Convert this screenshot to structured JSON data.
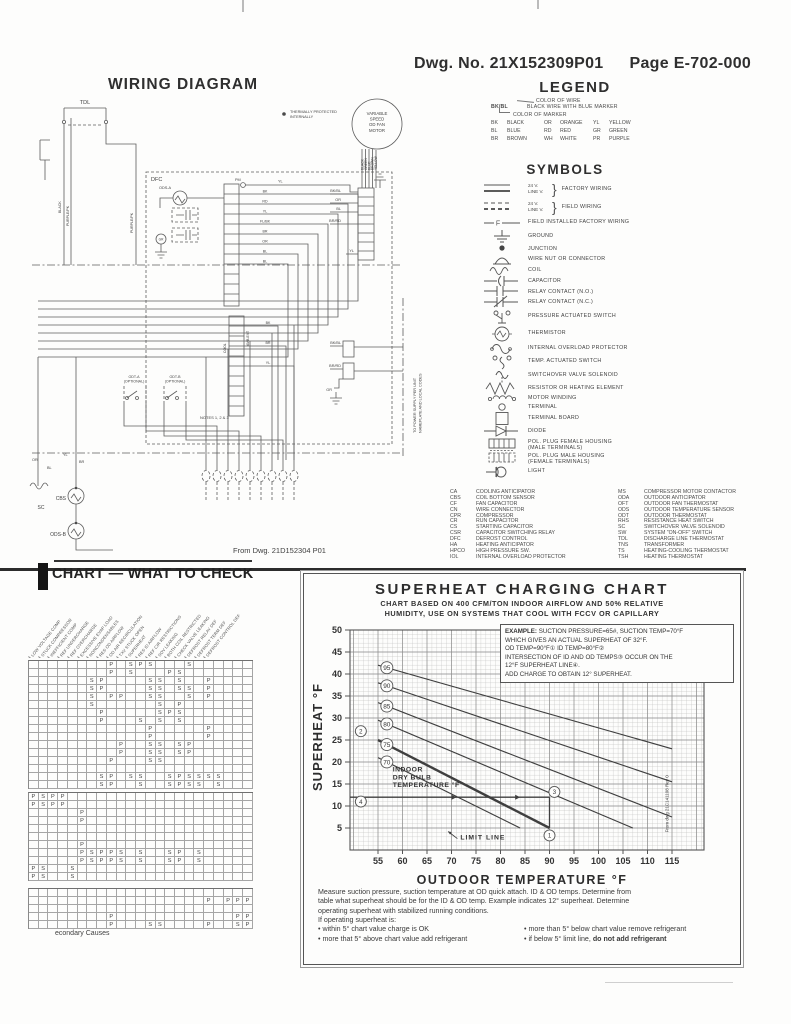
{
  "page": {
    "dwg_no": "Dwg. No. 21X152309P01",
    "page_no": "Page E-702-000"
  },
  "legend": {
    "title": "LEGEND",
    "note_line1": "COLOR OF WIRE",
    "note_code": "BK/BL",
    "note_line2": "BLACK WIRE WITH BLUE MARKER",
    "note_line3": "COLOR OF MARKER",
    "wire_colors": [
      [
        "BK",
        "BLACK"
      ],
      [
        "OR",
        "ORANGE"
      ],
      [
        "YL",
        "YELLOW"
      ],
      [
        "BL",
        "BLUE"
      ],
      [
        "RD",
        "RED"
      ],
      [
        "GR",
        "GREEN"
      ],
      [
        "BR",
        "BROWN"
      ],
      [
        "WH",
        "WHITE"
      ],
      [
        "PR",
        "PURPLE"
      ]
    ]
  },
  "symbols": {
    "title": "SYMBOLS",
    "items": [
      {
        "icon": "factory-wiring",
        "lines": [
          "24 V.",
          "LINE V."
        ],
        "label": "FACTORY WIRING",
        "h": 18
      },
      {
        "icon": "field-wiring",
        "lines": [
          "24 V.",
          "LINE V."
        ],
        "label": "FIELD WIRING",
        "h": 18
      },
      {
        "icon": "field-installed-wiring",
        "glyph": "F",
        "label": "FIELD INSTALLED FACTORY WIRING",
        "h": 13
      },
      {
        "icon": "ground",
        "label": "GROUND",
        "h": 15
      },
      {
        "icon": "junction",
        "label": "JUNCTION",
        "h": 10
      },
      {
        "icon": "wire-nut",
        "label": "WIRE NUT OR CONNECTOR",
        "h": 11
      },
      {
        "icon": "coil",
        "label": "COIL",
        "h": 11
      },
      {
        "icon": "capacitor",
        "label": "CAPACITOR",
        "h": 11
      },
      {
        "icon": "relay-contact-no",
        "label": "RELAY CONTACT (N.O.)",
        "h": 10
      },
      {
        "icon": "relay-contact-nc",
        "label": "RELAY CONTACT (N.C.)",
        "h": 11
      },
      {
        "icon": "pressure-switch",
        "label": "PRESSURE ACTUATED SWITCH",
        "h": 17
      },
      {
        "icon": "thermistor",
        "label": "THERMISTOR",
        "h": 17
      },
      {
        "icon": "overload-protector",
        "label": "INTERNAL OVERLOAD PROTECTOR",
        "h": 13
      },
      {
        "icon": "temp-switch",
        "label": "TEMP. ACTUATED SWITCH",
        "h": 13
      },
      {
        "icon": "solenoid",
        "label": "SWITCHOVER VALVE SOLENOID",
        "h": 15
      },
      {
        "icon": "resistor",
        "label": "RESISTOR OR HEATING ELEMENT",
        "h": 11
      },
      {
        "icon": "motor-winding",
        "label": "MOTOR WINDING",
        "h": 9
      },
      {
        "icon": "terminal",
        "label": "TERMINAL",
        "h": 9
      },
      {
        "icon": "terminal-board",
        "label": "TERMINAL BOARD",
        "h": 13
      },
      {
        "icon": "diode",
        "label": "DIODE",
        "h": 13
      },
      {
        "icon": "pol-plug-female",
        "label": "POL. PLUG FEMALE HOUSING",
        "label2": "(MALE TERMINALS)",
        "h": 14
      },
      {
        "icon": "pol-plug-male",
        "label": "POL. PLUG MALE HOUSING",
        "label2": "(FEMALE TERMINALS)",
        "h": 14
      },
      {
        "icon": "light",
        "label": "LIGHT",
        "h": 11
      }
    ]
  },
  "abbreviations": {
    "left": [
      [
        "CA",
        "COOLING ANTICIPATOR"
      ],
      [
        "CBS",
        "COIL BOTTOM SENSOR"
      ],
      [
        "CF",
        "FAN CAPACITOR"
      ],
      [
        "CN",
        "WIRE CONNECTOR"
      ],
      [
        "CPR",
        "COMPRESSOR"
      ],
      [
        "CR",
        "RUN CAPACITOR"
      ],
      [
        "CS",
        "STARTING CAPACITOR"
      ],
      [
        "CSR",
        "CAPACITOR SWITCHING RELAY"
      ],
      [
        "DFC",
        "DEFROST CONTROL"
      ],
      [
        "HA",
        "HEATING ANTICIPATOR"
      ],
      [
        "HPCO",
        "HIGH PRESSURE SW."
      ],
      [
        "IOL",
        "INTERNAL OVERLOAD PROTECTOR"
      ]
    ],
    "right": [
      [
        "MS",
        "COMPRESSOR MOTOR CONTACTOR"
      ],
      [
        "ODA",
        "OUTDOOR ANTICIPATOR"
      ],
      [
        "OFT",
        "OUTDOOR FAN THERMOSTAT"
      ],
      [
        "ODS",
        "OUTDOOR TEMPERATURE SENSOR"
      ],
      [
        "ODT",
        "OUTDOOR THERMOSTAT"
      ],
      [
        "RHS",
        "RESISTANCE HEAT SWITCH"
      ],
      [
        "SC",
        "SWITCHOVER VALVE SOLENOID"
      ],
      [
        "SW",
        "SYSTEM \"ON-OFF\" SWITCH"
      ],
      [
        "TDL",
        "DISCHARGE LINE THERMOSTAT"
      ],
      [
        "TNS",
        "TRANSFORMER"
      ],
      [
        "TS",
        "HEATING-COOLING THERMOSTAT"
      ],
      [
        "TSH",
        "HEATING THERMOSTAT"
      ]
    ]
  },
  "wiring": {
    "title": "WIRING DIAGRAM",
    "labels": {
      "tdl": "TDL",
      "dfc": "DFC",
      "pm": "PM",
      "yl1": "YL",
      "ods_a": "ODS-A",
      "gr": "GR",
      "motor": [
        "VARIABLE",
        "SPEED",
        "OD FAN",
        "MOTOR"
      ],
      "thermal_note": [
        "THERMALLY PROTECTED",
        "INTERNALLY"
      ],
      "strip_wires": [
        "BK",
        "RD",
        "YL",
        "FL/BK",
        "BR",
        "OR",
        "BL",
        "BL"
      ],
      "strip2_wires": [
        "BK",
        "BR",
        "YL"
      ],
      "conn_labels": [
        "BK/BL",
        "OR",
        "BL",
        "BR/RD",
        "YL"
      ],
      "motor_wires": [
        "BLACK",
        "GREEN",
        "BLUE",
        "BROWN",
        "YELLOW"
      ],
      "power_labels": [
        "BK/BL",
        "BR/RD",
        "GR"
      ],
      "left_wires": [
        "OR",
        "BL",
        "YL",
        "BR"
      ],
      "odt_a": [
        "ODT-A",
        "(OPTIONAL)"
      ],
      "odt_b": [
        "ODT-B",
        "(OPTIONAL)"
      ],
      "notes": "NOTES 1, 2 & 3",
      "sc": "SC",
      "cbs": "CBS",
      "ods_b": "ODS-B",
      "cool": "COOL",
      "amb": "AMB-EXT",
      "black": "BLACK",
      "purple1": "PURPLE/PK",
      "purple2": "PURPLE/PK",
      "from": "From Dwg. 21D152304 P01",
      "power": [
        "TO POWER SUPPLY PER UNIT",
        "NAMEPLATE AND LOCAL CODES"
      ]
    }
  },
  "check_chart": {
    "title": "CHART — WHAT TO CHECK",
    "caption": "econdary Causes",
    "columns": [
      "LOW VOLTAGE COMP",
      "STUCK COMPRESSOR",
      "INEFFICIENT COMP",
      "REF UNDERCHARGE",
      "REF OVERCHARGE",
      "EXCESSIVE EVAP LOAD",
      "NONCONDENSABLES",
      "RES OD AIRFLOW",
      "OD AIR RECIRCULATION",
      "TXV STUCK OPEN",
      "SUPERHEAT",
      "RES ID AIRFLOW",
      "REF CIR RESTRICTIONS",
      "SOV LEAKING",
      "BOTH COIL RESTRICTED",
      "CHECK VALVE LEAKING",
      "DEFROST RELAY DEF",
      "DEFROST TERM DEF",
      "DEFROST CONTROL DEF",
      "",
      "",
      "",
      ""
    ],
    "sections": [
      {
        "rows": [
          {
            "9": "P",
            "11": "S",
            "12": "P",
            "13": "S",
            "17": "S"
          },
          {
            "9": "P",
            "11": "S",
            "15": "P",
            "16": "S"
          },
          {
            "7": "S",
            "8": "P",
            "13": "S",
            "14": "S",
            "16": "S",
            "19": "P"
          },
          {
            "7": "S",
            "8": "P",
            "13": "S",
            "14": "S",
            "16": "S",
            "17": "S",
            "19": "P"
          },
          {
            "7": "S",
            "9": "P",
            "10": "P",
            "13": "S",
            "14": "S",
            "17": "S",
            "19": "P"
          },
          {
            "7": "S",
            "14": "S",
            "16": "P"
          },
          {
            "8": "P",
            "14": "S",
            "15": "P",
            "16": "S"
          },
          {
            "8": "P",
            "12": "S",
            "14": "S",
            "16": "S"
          },
          {
            "13": "P",
            "19": "P"
          },
          {
            "13": "P",
            "19": "P"
          },
          {
            "10": "P",
            "13": "S",
            "14": "S",
            "16": "S",
            "17": "P"
          },
          {
            "10": "P",
            "13": "S",
            "14": "S",
            "16": "S",
            "17": "P"
          },
          {
            "9": "P",
            "13": "S",
            "14": "S"
          },
          {},
          {
            "8": "S",
            "9": "P",
            "11": "S",
            "12": "S",
            "15": "S",
            "16": "P",
            "17": "S",
            "18": "S",
            "19": "S",
            "20": "S"
          },
          {
            "8": "S",
            "9": "P",
            "12": "S",
            "15": "S",
            "16": "P",
            "17": "S",
            "18": "S",
            "20": "S"
          }
        ]
      },
      {
        "rows": [
          {
            "1": "P",
            "2": "S",
            "3": "P",
            "4": "P"
          },
          {
            "1": "P",
            "2": "S",
            "3": "P",
            "4": "P"
          },
          {
            "6": "P"
          },
          {
            "6": "P"
          },
          {},
          {},
          {
            "6": "P"
          },
          {
            "6": "P",
            "7": "S",
            "8": "P",
            "9": "P",
            "10": "S",
            "12": "S",
            "15": "S",
            "16": "P",
            "18": "S"
          },
          {
            "6": "P",
            "7": "S",
            "8": "P",
            "9": "P",
            "10": "S",
            "12": "S",
            "15": "S",
            "16": "P",
            "18": "S"
          },
          {
            "1": "P",
            "2": "S",
            "5": "S"
          },
          {
            "1": "P",
            "2": "S",
            "5": "S"
          }
        ]
      },
      {
        "rows": [
          {},
          {
            "19": "P",
            "21": "P",
            "22": "P",
            "23": "P"
          },
          {},
          {
            "9": "P",
            "22": "P",
            "23": "P"
          },
          {
            "9": "P",
            "13": "S",
            "14": "S",
            "19": "P",
            "22": "S",
            "23": "P"
          }
        ]
      }
    ]
  },
  "superheat": {
    "title": "SUPERHEAT CHARGING CHART",
    "subtitle1": "CHART BASED ON 400 CFM/TON INDOOR AIRFLOW AND 50% RELATIVE",
    "subtitle2": "HUMIDITY, USE ON SYSTEMS THAT COOL WITH  FCCV OR CAPILLARY",
    "example_label": "EXAMPLE:",
    "example_lines": [
      "SUCTION PRESSURE=65#, SUCTION TEMP=70°F",
      "WHICH GIVES AN ACTUAL SUPERHEAT OF 32°F.",
      "OD TEMP=90°F① ID TEMP=80°F②",
      "INTERSECTION OF ID AND OD TEMPS③ OCCUR ON THE",
      "12°F SUPERHEAT LINE④.",
      "ADD CHARGE TO OBTAIN 12° SUPERHEAT."
    ],
    "ylabel": "SUPERHEAT °F",
    "xlabel": "OUTDOOR TEMPERATURE °F",
    "source": "From dwg 21C141108 Rev 0",
    "footer_lines": [
      "Measure suction pressure, suction temperature at OD quick attach. ID & OD temps. Determine from",
      "table what superheat should be for the ID & OD temp. Example indicates 12° superheat. Determine",
      "operating superheat with stabilized running conditions.",
      "If operating superheat is:"
    ],
    "bullets_left": [
      "within 5° chart value charge is OK",
      "more that 5° above chart value add refrigerant"
    ],
    "bullet_right_1": "more than 5° below chart value remove refrigerant",
    "bullet_right_2_prefix": "if below 5° limit line, ",
    "bullet_right_2_bold": "do not add refrigerant"
  },
  "chart_data": {
    "type": "line",
    "title": "SUPERHEAT CHARGING CHART",
    "xlabel": "OUTDOOR TEMPERATURE °F",
    "ylabel": "SUPERHEAT °F",
    "xlim": [
      49,
      121
    ],
    "ylim": [
      0,
      50
    ],
    "xticks": [
      55,
      60,
      65,
      70,
      75,
      80,
      85,
      90,
      95,
      100,
      105,
      110,
      115
    ],
    "yticks": [
      5,
      10,
      15,
      20,
      25,
      30,
      35,
      40,
      45,
      50
    ],
    "grid": true,
    "series_label": "INDOOR DRY BULB TEMPERATURE °F",
    "indoor_label_lines": [
      "INDOOR",
      "DRY BULB",
      "TEMPERATURE °F"
    ],
    "limit_label": "LIMIT LINE",
    "series": [
      {
        "name": "95",
        "points": [
          [
            55,
            42
          ],
          [
            115,
            23
          ]
        ]
      },
      {
        "name": "90",
        "points": [
          [
            55,
            38
          ],
          [
            115,
            15.5
          ]
        ]
      },
      {
        "name": "85",
        "points": [
          [
            55,
            33.5
          ],
          [
            115,
            7.5
          ]
        ]
      },
      {
        "name": "80",
        "points": [
          [
            55,
            29.5
          ],
          [
            107,
            5
          ]
        ]
      },
      {
        "name": "75",
        "points": [
          [
            55,
            25
          ],
          [
            90,
            5
          ]
        ],
        "emphasis": true
      },
      {
        "name": "70",
        "points": [
          [
            55,
            21
          ],
          [
            84,
            5
          ]
        ]
      }
    ],
    "annotations": {
      "example_superheat_line": {
        "y": 12,
        "x_to": 90
      },
      "example_vertical": {
        "x": 90,
        "y_from": 12,
        "y_to": 5
      },
      "markers": [
        {
          "n": "1",
          "x": 90,
          "y": 3.3
        },
        {
          "n": "2",
          "x": 51.5,
          "y": 27
        },
        {
          "n": "3",
          "x": 91,
          "y": 13.2
        },
        {
          "n": "4",
          "x": 51.5,
          "y": 11
        }
      ]
    }
  }
}
